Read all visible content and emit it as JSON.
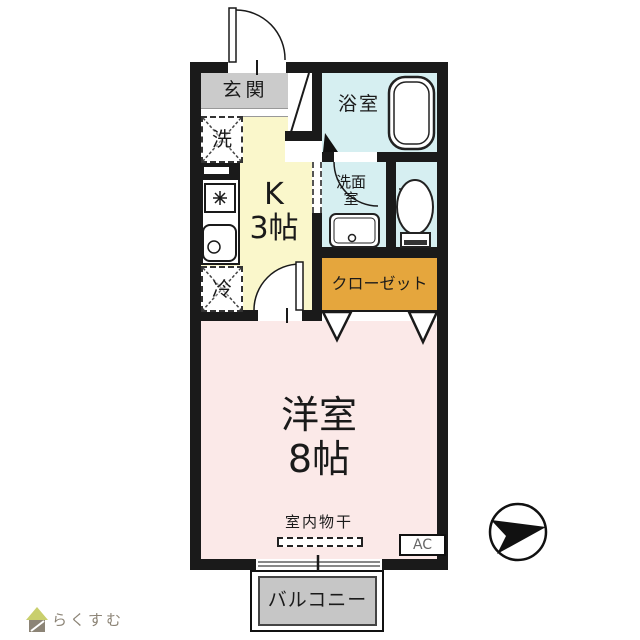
{
  "plan": {
    "entrance_label": "玄関",
    "bathroom_label": "浴室",
    "washer_label": "洗",
    "fridge_label": "冷",
    "kitchen_label_line1": "K",
    "kitchen_label_line2": "3帖",
    "washroom_label_line1": "洗面",
    "washroom_label_line2": "室",
    "closet_label": "クローゼット",
    "main_room_label_line1": "洋室",
    "main_room_label_line2": "8帖",
    "drying_label": "室内物干",
    "ac_label": "AC",
    "balcony_label": "バルコニー"
  },
  "branding": {
    "logo_text": "らくすむ"
  },
  "icons": {
    "north_arrow": "circle with black arrow pointing right",
    "house_logo": "small house with green roof",
    "bathtub": "rounded rectangle tub",
    "toilet": "toilet bowl with base",
    "stove": "burner snowflake symbol",
    "sink": "basin with drain circle"
  },
  "colors": {
    "wall": "#1a1a1a",
    "genkan": "#cbcbcb",
    "kitchen": "#faf7cb",
    "water": "#d6eff1",
    "closet": "#e5a63d",
    "room": "#fbe9e8",
    "balcony": "#c6c6c6",
    "logo_green": "#c9cf6d",
    "logo_gray": "#8c8476"
  }
}
